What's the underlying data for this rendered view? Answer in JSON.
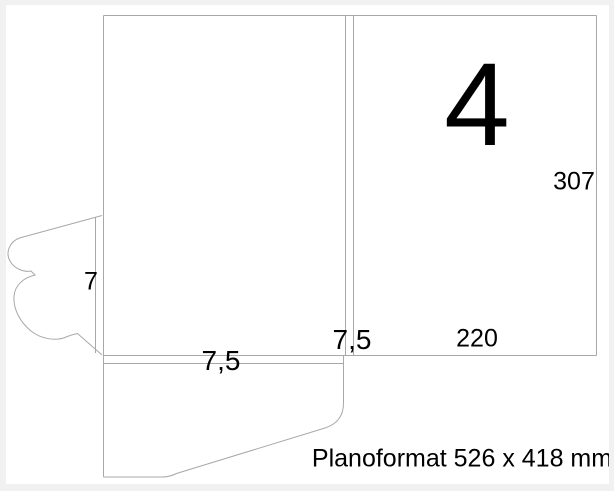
{
  "dieline": {
    "panel_number": "4",
    "dimensions": {
      "height_mm": "307",
      "width_mm": "220",
      "spine_mm": "7,5",
      "pocket_fold_mm": "7,5",
      "tab_mm": "7"
    },
    "caption": "Planoformat 526 x 418 mm"
  },
  "colors": {
    "line": "#a8a8a8",
    "text": "#000000",
    "background": "#ffffff",
    "frame": "#f1f1f2"
  }
}
